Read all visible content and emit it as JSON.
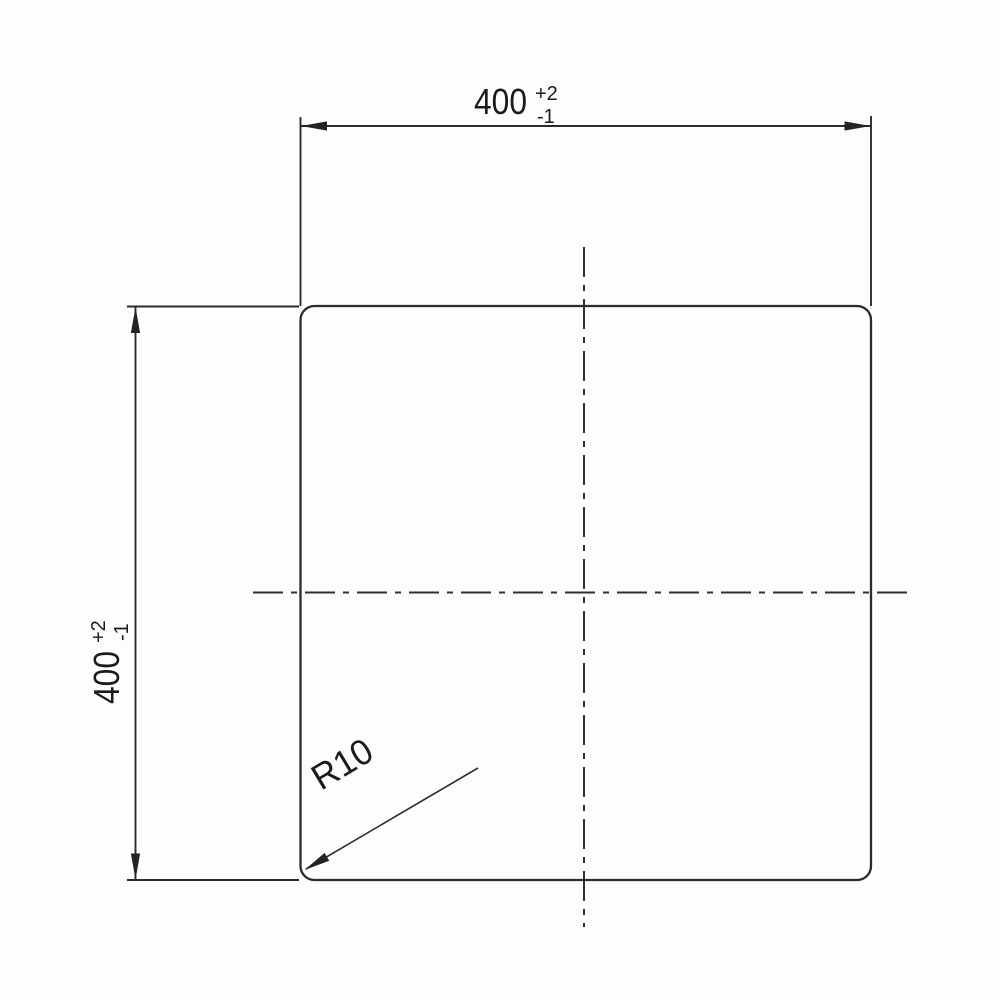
{
  "drawing": {
    "dim_horizontal": {
      "value": "400",
      "tol_plus": "+2",
      "tol_minus": "-1"
    },
    "dim_vertical": {
      "value": "400",
      "tol_plus": "+2",
      "tol_minus": "-1"
    },
    "radius_callout": {
      "label": "R10"
    },
    "colors": {
      "line": "#2b2b2b",
      "text": "#1b1b1b",
      "background": "#fdfdfd"
    }
  }
}
